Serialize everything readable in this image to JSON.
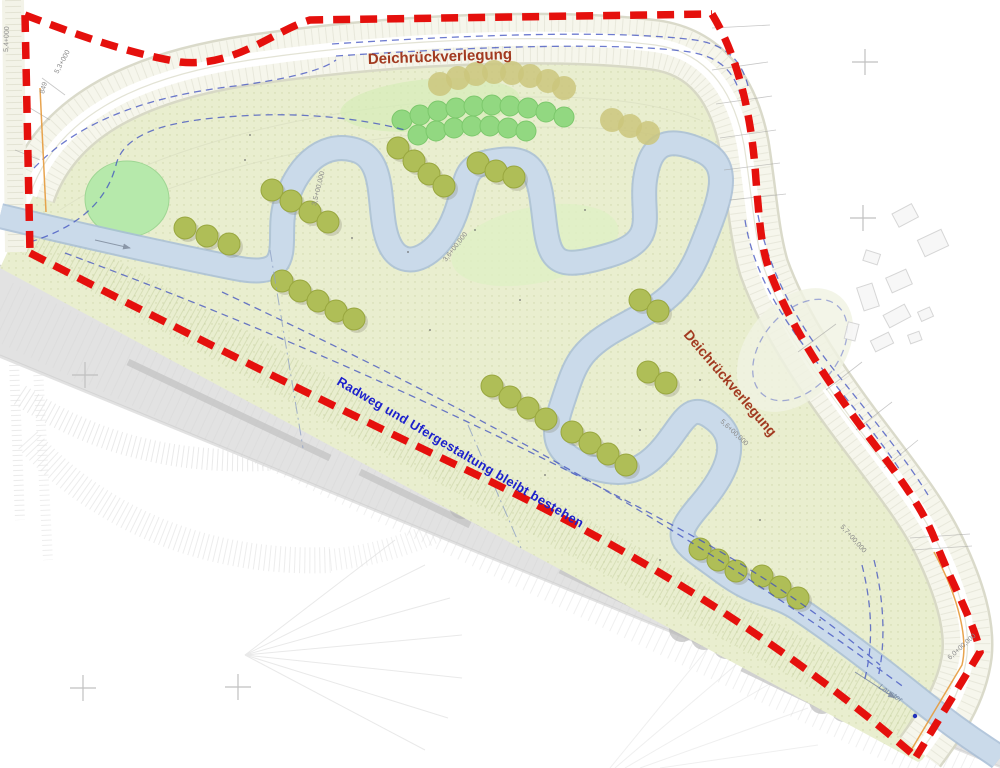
{
  "plan": {
    "labels": {
      "dike_relocation_top": "Deichrückverlegung",
      "dike_relocation_right": "Deichrückverlegung",
      "bike_path_note": "Radweg und Ufergestaltung bleibt bestehen",
      "stream_name": "Lauster"
    },
    "stations": [
      {
        "text": "5,4+000"
      },
      {
        "text": "5,3+000"
      },
      {
        "text": "849"
      },
      {
        "text": "3,5+00,000"
      },
      {
        "text": "3,6+00,000"
      },
      {
        "text": "5,6+00,000"
      },
      {
        "text": "5,7+00,000"
      },
      {
        "text": "6,0+00,000"
      }
    ],
    "colors": {
      "boundary_red": "#e5100d",
      "dike_label": "#a23a20",
      "note_blue": "#1c20cc",
      "river": "#cadaea",
      "river_edge": "#a7bdd6",
      "floodplain": "#e9eecf",
      "pond": "#b6e9ab",
      "bushes": "#92d881",
      "trees": "#afbe57",
      "road": "#e2e2e2",
      "blue_guides": "#3d4fc0"
    }
  }
}
